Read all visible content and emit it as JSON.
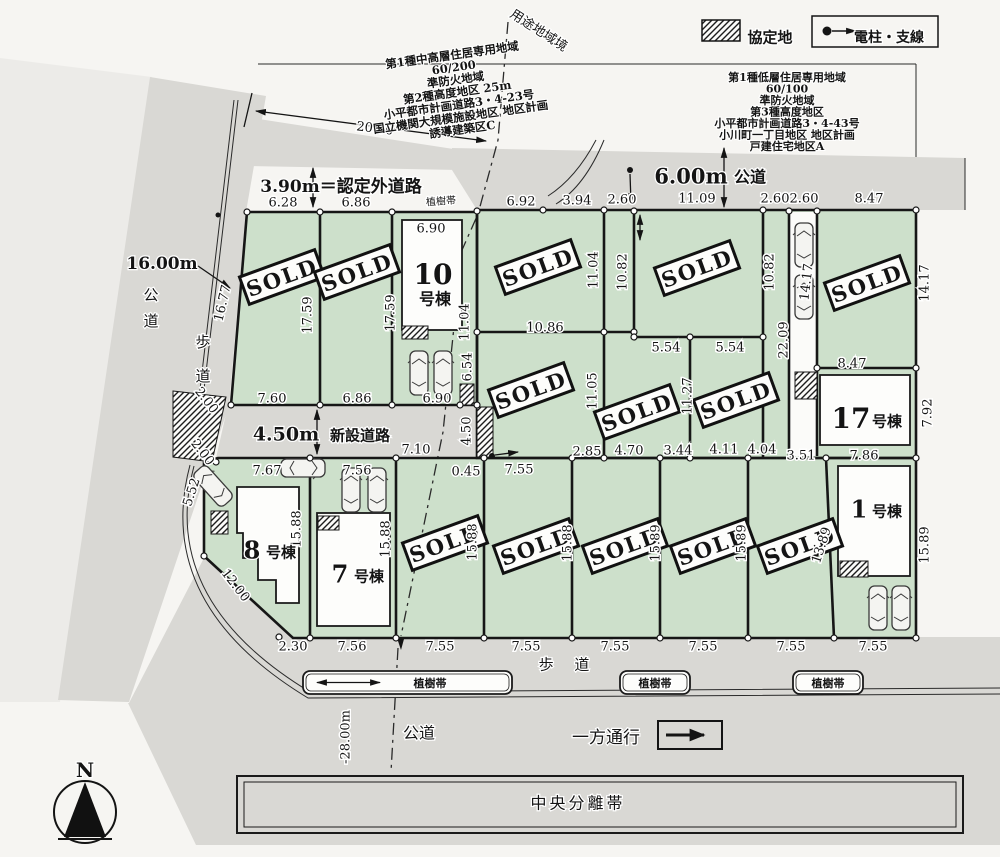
{
  "colors": {
    "lot_green": "#cde0cb",
    "road_gray": "#d9d8d4",
    "page": "#f6f5f2",
    "line": "#161616",
    "shade_left": "#ecebe8"
  },
  "sold_label": "SOLD",
  "legend": {
    "agreement_label": "協定地",
    "pole_label": "電柱・支線"
  },
  "annotation_left": {
    "lines": [
      "第1種中高層住居専用地域",
      "60/200",
      "準防火地域",
      "第2種高度地区 25m",
      "小平都市計画道路3・4-23号",
      "国立機関大規模施設地区 地区計画",
      "誘導建築区C"
    ]
  },
  "annotation_right": {
    "lines": [
      "第1種低層住居専用地域",
      "60/100",
      "準防火地域",
      "第3種高度地区",
      "小平都市計画道路3・4-43号",
      "小川町一丁目地区 地区計画",
      "戸建住宅地区A"
    ]
  },
  "labels": [
    {
      "t": "3.90m＝認定外道路",
      "x": 341,
      "y": 186,
      "s": 17,
      "b": 1
    },
    {
      "t": "16.00m",
      "x": 162,
      "y": 263,
      "s": 17,
      "b": 1
    },
    {
      "t": "公道",
      "x": 151,
      "y": 300,
      "s": 15,
      "stack": 1,
      "gap": 26
    },
    {
      "t": "歩道",
      "x": 203,
      "y": 347,
      "s": 15,
      "stack": 1,
      "gap": 34
    },
    {
      "t": "4.50m",
      "x": 286,
      "y": 434,
      "s": 19,
      "b": 1
    },
    {
      "t": "新設道路",
      "x": 360,
      "y": 435,
      "s": 15,
      "b": 1
    },
    {
      "t": "6.00m",
      "x": 691,
      "y": 176,
      "s": 21,
      "b": 1
    },
    {
      "t": "公道",
      "x": 750,
      "y": 177,
      "s": 16,
      "b": 1
    },
    {
      "t": "用途地域境",
      "x": 539,
      "y": 30,
      "s": 13,
      "r": 33
    },
    {
      "t": "植樹帯",
      "x": 441,
      "y": 201,
      "s": 10,
      "r": -4
    },
    {
      "t": "歩 道",
      "x": 568,
      "y": 664,
      "s": 15,
      "ls": 8
    },
    {
      "t": "公道",
      "x": 419,
      "y": 733,
      "s": 16
    },
    {
      "t": "一方通行",
      "x": 606,
      "y": 737,
      "s": 17
    },
    {
      "t": "中央分離帯",
      "x": 578,
      "y": 803,
      "s": 16,
      "ls": 3
    },
    {
      "t": "N",
      "x": 85,
      "y": 770,
      "s": 20,
      "b": 1
    },
    {
      "t": "協定地",
      "x": 770,
      "y": 37,
      "s": 15,
      "b": 1
    },
    {
      "t": "電柱・支線",
      "x": 889,
      "y": 37,
      "s": 14,
      "b": 1
    },
    {
      "t": "10",
      "x": 433,
      "y": 274,
      "s": 28,
      "b": 1
    },
    {
      "t": "号棟",
      "x": 435,
      "y": 299,
      "s": 16,
      "b": 1
    },
    {
      "t": "17",
      "x": 851,
      "y": 418,
      "s": 28,
      "b": 1
    },
    {
      "t": "号棟",
      "x": 887,
      "y": 421,
      "s": 15,
      "b": 1
    },
    {
      "t": "8",
      "x": 252,
      "y": 550,
      "s": 24,
      "b": 1
    },
    {
      "t": "号棟",
      "x": 281,
      "y": 552,
      "s": 15,
      "b": 1
    },
    {
      "t": "7",
      "x": 340,
      "y": 574,
      "s": 24,
      "b": 1
    },
    {
      "t": "号棟",
      "x": 369,
      "y": 576,
      "s": 15,
      "b": 1
    },
    {
      "t": "1",
      "x": 859,
      "y": 509,
      "s": 24,
      "b": 1
    },
    {
      "t": "号棟",
      "x": 887,
      "y": 511,
      "s": 15,
      "b": 1
    }
  ],
  "dims": [
    {
      "t": "20.00",
      "x": 375,
      "y": 128,
      "r": 7
    },
    {
      "t": "6.28",
      "x": 283,
      "y": 202
    },
    {
      "t": "6.86",
      "x": 356,
      "y": 202
    },
    {
      "t": "6.92",
      "x": 521,
      "y": 201
    },
    {
      "t": "3.94",
      "x": 577,
      "y": 200
    },
    {
      "t": "2.60",
      "x": 622,
      "y": 199
    },
    {
      "t": "11.09",
      "x": 697,
      "y": 198
    },
    {
      "t": "2.60",
      "x": 775,
      "y": 198
    },
    {
      "t": "2.60",
      "x": 804,
      "y": 198
    },
    {
      "t": "8.47",
      "x": 869,
      "y": 198
    },
    {
      "t": "16.77",
      "x": 222,
      "y": 303,
      "r": -77
    },
    {
      "t": "17.59",
      "x": 307,
      "y": 315,
      "r": -90
    },
    {
      "t": "17.59",
      "x": 390,
      "y": 313,
      "r": -90
    },
    {
      "t": "6.90",
      "x": 431,
      "y": 228
    },
    {
      "t": "11.04",
      "x": 464,
      "y": 322,
      "r": -90
    },
    {
      "t": "6.90",
      "x": 437,
      "y": 398
    },
    {
      "t": "6.54",
      "x": 467,
      "y": 367,
      "r": -90
    },
    {
      "t": "7.60",
      "x": 272,
      "y": 398
    },
    {
      "t": "6.86",
      "x": 357,
      "y": 398
    },
    {
      "t": "10.86",
      "x": 545,
      "y": 327
    },
    {
      "t": "11.04",
      "x": 593,
      "y": 270,
      "r": -90
    },
    {
      "t": "10.82",
      "x": 622,
      "y": 272,
      "r": -90
    },
    {
      "t": "10.82",
      "x": 769,
      "y": 272,
      "r": -90
    },
    {
      "t": "5.54",
      "x": 666,
      "y": 347
    },
    {
      "t": "5.54",
      "x": 730,
      "y": 347
    },
    {
      "t": "22.09",
      "x": 783,
      "y": 340,
      "r": -90
    },
    {
      "t": "14.17",
      "x": 806,
      "y": 282,
      "r": -83
    },
    {
      "t": "8.47",
      "x": 852,
      "y": 363
    },
    {
      "t": "14.17",
      "x": 924,
      "y": 283,
      "r": -90
    },
    {
      "t": "7.92",
      "x": 927,
      "y": 413,
      "r": -90
    },
    {
      "t": "11.05",
      "x": 592,
      "y": 391,
      "r": -90
    },
    {
      "t": "11.27",
      "x": 687,
      "y": 396,
      "r": -90
    },
    {
      "t": "2.85",
      "x": 587,
      "y": 451
    },
    {
      "t": "4.70",
      "x": 629,
      "y": 450
    },
    {
      "t": "3.44",
      "x": 678,
      "y": 450
    },
    {
      "t": "4.11",
      "x": 724,
      "y": 449
    },
    {
      "t": "4.04",
      "x": 762,
      "y": 449
    },
    {
      "t": "3.51",
      "x": 801,
      "y": 455
    },
    {
      "t": "7.86",
      "x": 864,
      "y": 455
    },
    {
      "t": "4.50",
      "x": 466,
      "y": 431,
      "r": -90
    },
    {
      "t": "7.10",
      "x": 416,
      "y": 449
    },
    {
      "t": "0.45",
      "x": 466,
      "y": 471
    },
    {
      "t": "7.55",
      "x": 519,
      "y": 469
    },
    {
      "t": "2.00",
      "x": 207,
      "y": 400,
      "r": 52
    },
    {
      "t": "2.00",
      "x": 203,
      "y": 452,
      "r": 52
    },
    {
      "t": "5.52",
      "x": 191,
      "y": 492,
      "r": -72
    },
    {
      "t": "7.67",
      "x": 267,
      "y": 470
    },
    {
      "t": "7.56",
      "x": 357,
      "y": 470
    },
    {
      "t": "15.88",
      "x": 296,
      "y": 529,
      "r": -90
    },
    {
      "t": "15.88",
      "x": 385,
      "y": 539,
      "r": -90
    },
    {
      "t": "12.00",
      "x": 236,
      "y": 585,
      "r": 52
    },
    {
      "t": "15.88",
      "x": 472,
      "y": 542,
      "r": -90
    },
    {
      "t": "15.88",
      "x": 567,
      "y": 543,
      "r": -90
    },
    {
      "t": "15.89",
      "x": 655,
      "y": 543,
      "r": -90
    },
    {
      "t": "15.89",
      "x": 741,
      "y": 543,
      "r": -90
    },
    {
      "t": "13.89",
      "x": 821,
      "y": 545,
      "r": -72
    },
    {
      "t": "15.89",
      "x": 924,
      "y": 545,
      "r": -90
    },
    {
      "t": "2.30",
      "x": 293,
      "y": 646
    },
    {
      "t": "7.56",
      "x": 352,
      "y": 646
    },
    {
      "t": "7.55",
      "x": 440,
      "y": 646
    },
    {
      "t": "7.55",
      "x": 526,
      "y": 646
    },
    {
      "t": "7.55",
      "x": 615,
      "y": 646
    },
    {
      "t": "7.55",
      "x": 703,
      "y": 646
    },
    {
      "t": "7.55",
      "x": 791,
      "y": 646
    },
    {
      "t": "7.55",
      "x": 873,
      "y": 646
    },
    {
      "t": "-28.00m",
      "x": 345,
      "y": 737,
      "r": -90
    }
  ],
  "stamps": [
    {
      "x": 282,
      "y": 277,
      "r": -20
    },
    {
      "x": 357,
      "y": 272,
      "r": -20
    },
    {
      "x": 538,
      "y": 267,
      "r": -20
    },
    {
      "x": 697,
      "y": 268,
      "r": -20
    },
    {
      "x": 867,
      "y": 283,
      "r": -20
    },
    {
      "x": 531,
      "y": 390,
      "r": -20
    },
    {
      "x": 637,
      "y": 412,
      "r": -20
    },
    {
      "x": 736,
      "y": 400,
      "r": -20
    },
    {
      "x": 445,
      "y": 543,
      "r": -20
    },
    {
      "x": 536,
      "y": 546,
      "r": -20
    },
    {
      "x": 625,
      "y": 546,
      "r": -20
    },
    {
      "x": 713,
      "y": 546,
      "r": -20
    },
    {
      "x": 800,
      "y": 546,
      "r": -20
    }
  ],
  "tree_boxes": [
    {
      "label": "植樹帯",
      "x": 303,
      "y": 671,
      "w": 209,
      "h": 23,
      "lx": 430,
      "arrow": 1
    },
    {
      "label": "植樹帯",
      "x": 620,
      "y": 671,
      "w": 70,
      "h": 23,
      "lx": 655,
      "arrow": 0
    },
    {
      "label": "植樹帯",
      "x": 793,
      "y": 671,
      "w": 70,
      "h": 23,
      "lx": 828,
      "arrow": 0
    }
  ],
  "cars": [
    {
      "x": 419,
      "y": 373,
      "r": 0
    },
    {
      "x": 443,
      "y": 373,
      "r": 0
    },
    {
      "x": 804,
      "y": 245,
      "r": 0
    },
    {
      "x": 804,
      "y": 297,
      "r": 0
    },
    {
      "x": 213,
      "y": 486,
      "r": -42
    },
    {
      "x": 303,
      "y": 468,
      "r": 90
    },
    {
      "x": 351,
      "y": 490,
      "r": 0
    },
    {
      "x": 377,
      "y": 490,
      "r": 0
    },
    {
      "x": 878,
      "y": 608,
      "r": 0
    },
    {
      "x": 901,
      "y": 608,
      "r": 0
    }
  ]
}
